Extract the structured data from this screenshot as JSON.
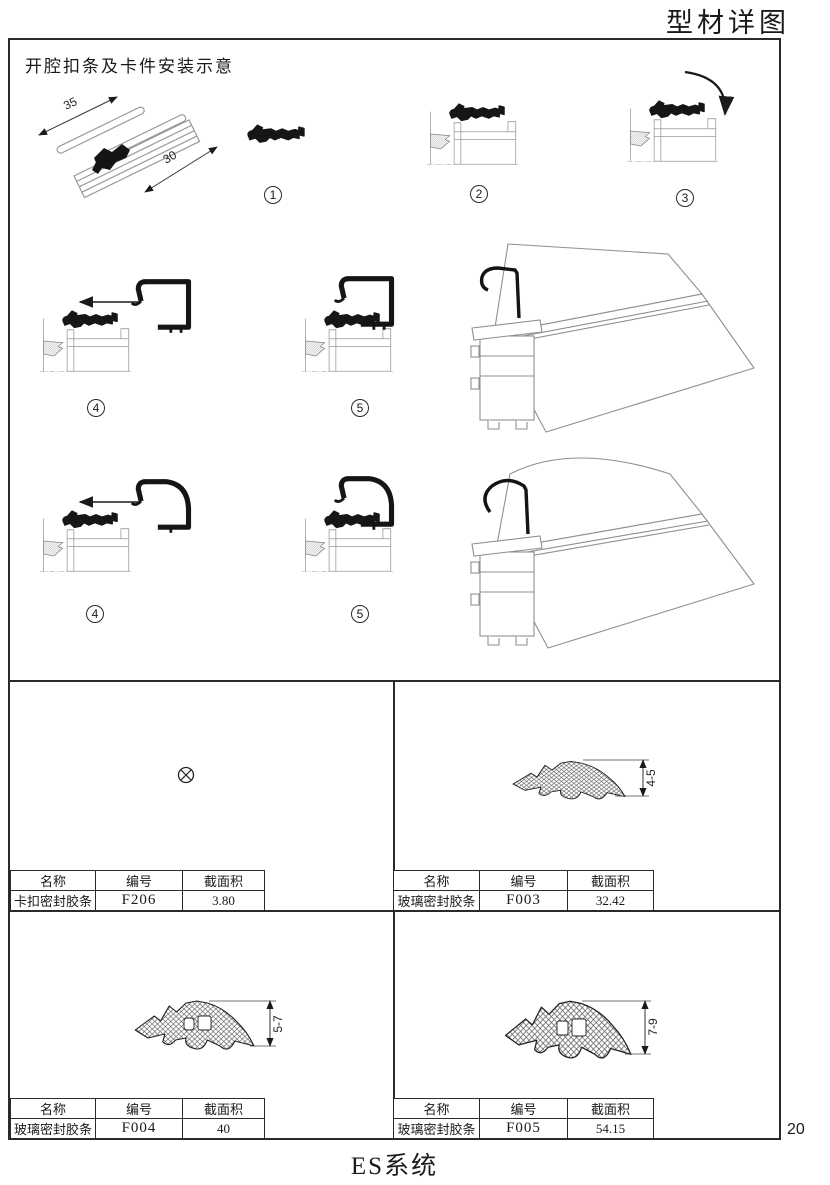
{
  "page": {
    "title": "型材详图",
    "footer_system": "ES系统",
    "page_number": "20"
  },
  "illustration": {
    "caption": "开腔扣条及卡件安装示意",
    "iso_dims": {
      "strip_length": "35",
      "profile_width": "30"
    },
    "step_labels": {
      "s1": "1",
      "s2": "2",
      "s3": "3",
      "s4": "4",
      "s5": "5",
      "s4b": "4",
      "s5b": "5"
    }
  },
  "table_headers": {
    "name": "名称",
    "code": "编号",
    "area": "截面积"
  },
  "panels": {
    "f206": {
      "name": "卡扣密封胶条",
      "code": "F206",
      "area": "3.80",
      "dim": ""
    },
    "f003": {
      "name": "玻璃密封胶条",
      "code": "F003",
      "area": "32.42",
      "dim": "4-5"
    },
    "f004": {
      "name": "玻璃密封胶条",
      "code": "F004",
      "area": "40",
      "dim": "5-7"
    },
    "f005": {
      "name": "玻璃密封胶条",
      "code": "F005",
      "area": "54.15",
      "dim": "7-9"
    }
  }
}
